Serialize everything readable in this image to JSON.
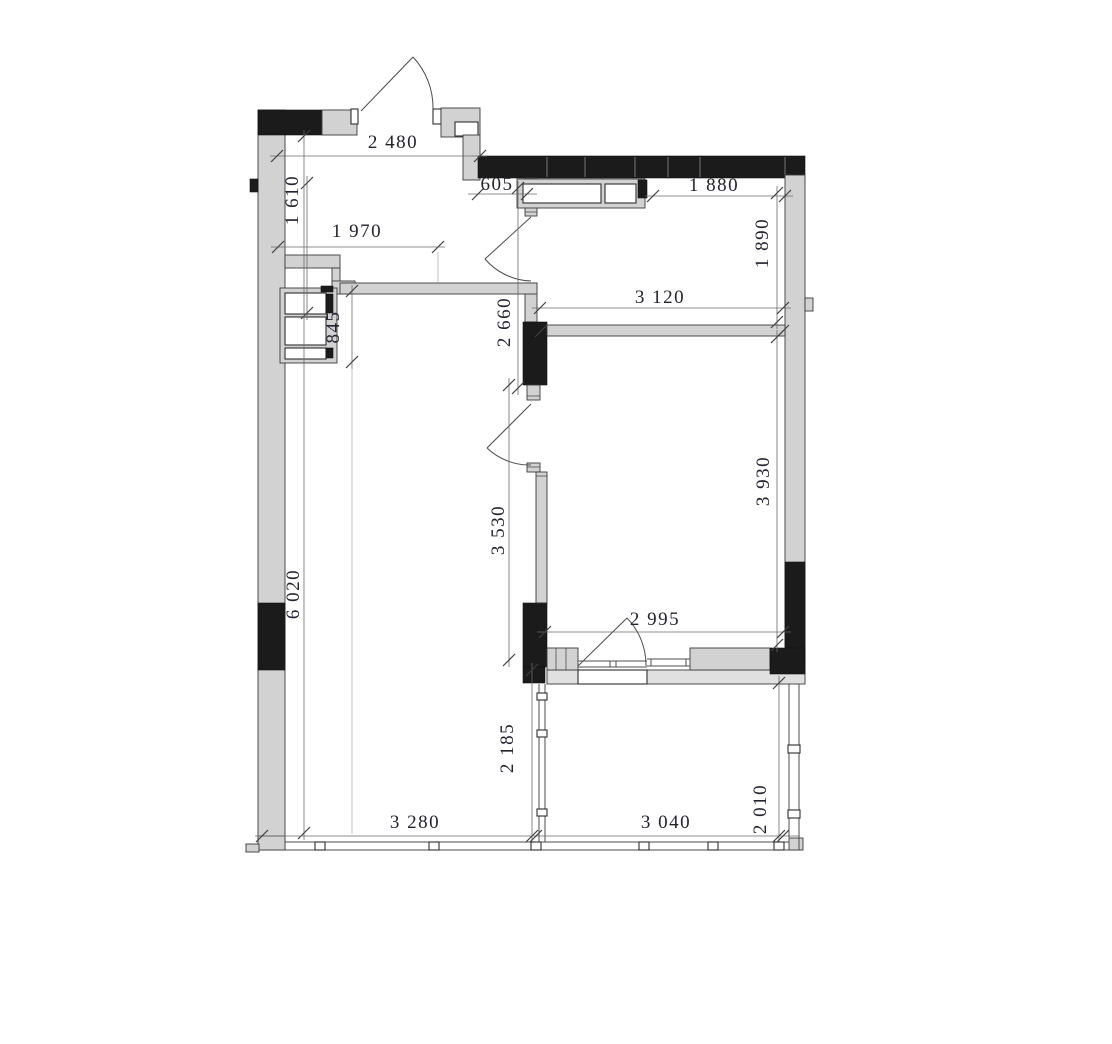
{
  "drawing": {
    "title": "apartment-floor-plan",
    "units": "mm",
    "colors": {
      "wall_fill": "#d2d2d2",
      "wall_black": "#1b1b1b",
      "outline": "#3b3b3b",
      "dimension_line": "#6a6a6a",
      "dimension_text": "#222230",
      "background": "#ffffff"
    },
    "dimensions": {
      "entry_width": "2 480",
      "entry_depth": "1 610",
      "kitchen_zone_width": "1 970",
      "duct_height": "845",
      "bath_entry_offset": "605",
      "bath_width": "1 880",
      "bath_depth": "1 890",
      "hall_width": "3 120",
      "hall_depth": "2 660",
      "bedroom_width": "2 995",
      "bedroom_depth": "3 930",
      "living_mid_depth": "3 530",
      "living_depth": "6 020",
      "balcony_left_depth": "2 185",
      "living_width": "3 280",
      "balcony_width": "3 040",
      "balcony_right_depth": "2 010"
    }
  }
}
